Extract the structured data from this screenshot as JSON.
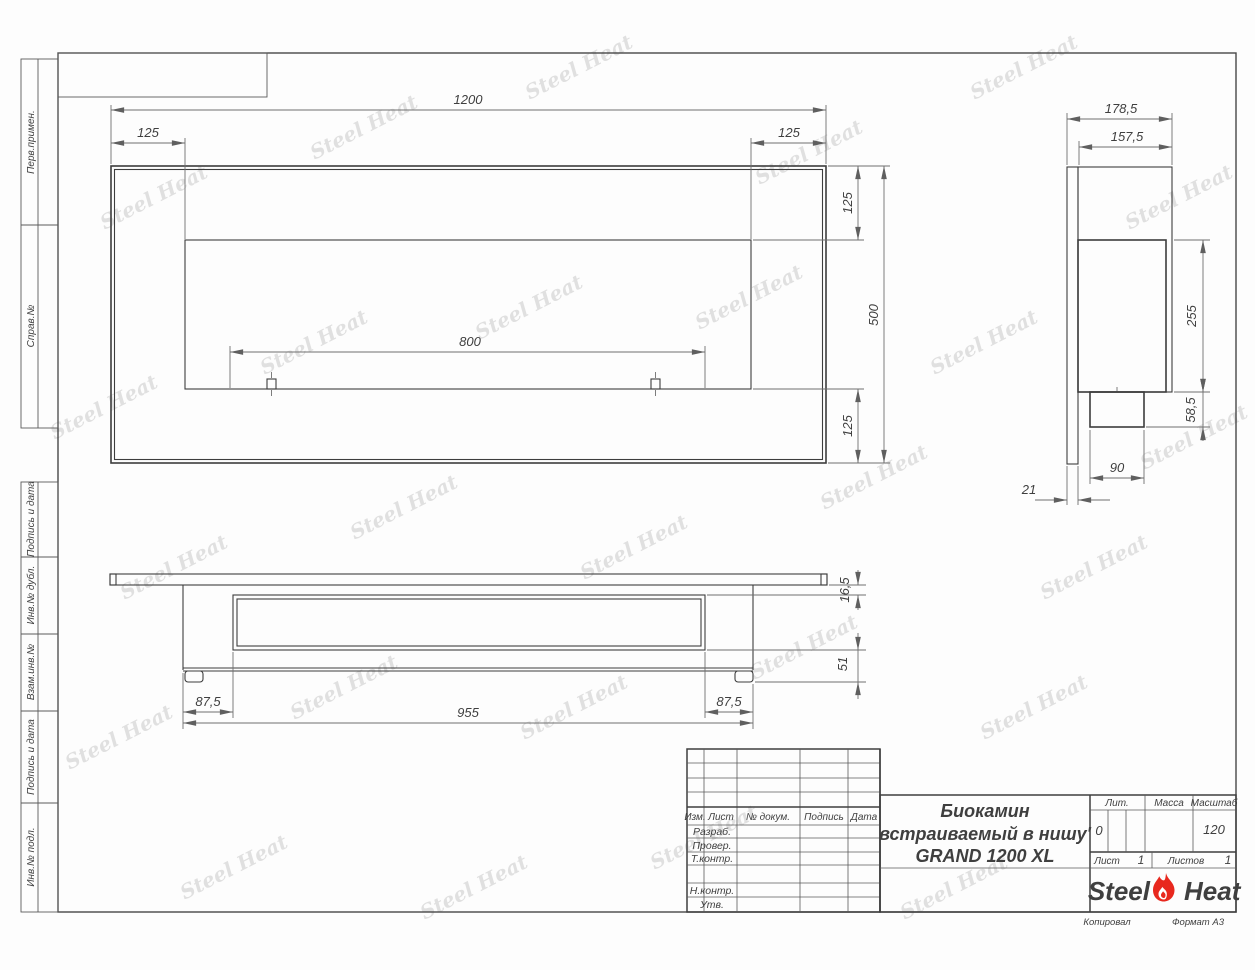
{
  "watermark": {
    "text": "Steel Heat"
  },
  "left_strip": {
    "items": [
      "Перв.примен.",
      "Справ.№",
      "Подпись и дата",
      "Инв.№ дубл.",
      "Взам.инв.№",
      "Подпись и дата",
      "Инв.№ подл."
    ]
  },
  "title_block": {
    "header_cols": {
      "izm": "Изм.",
      "list": "Лист",
      "doc": "№ докум.",
      "sign": "Подпись",
      "date": "Дата"
    },
    "rows": {
      "razrab": "Разраб.",
      "prover": "Провер.",
      "tkontr": "Т.контр.",
      "nkontr": "Н.контр.",
      "utv": "Утв."
    },
    "title_line1": "Биокамин",
    "title_line2": "встраиваемый в нишу'",
    "title_line3": "GRAND 1200 XL",
    "lit_label": "Лит.",
    "lit_value": "0",
    "mass_label": "Масса",
    "scale_label": "Масштаб",
    "scale_value": "120",
    "sheet_label": "Лист",
    "sheet_value": "1",
    "sheets_label": "Листов",
    "sheets_value": "1",
    "logo": {
      "steel": "Steel",
      "heat": "Heat",
      "flame_color": "#e8281e"
    },
    "footer_left": "Копировал",
    "footer_right": "Формат А3"
  },
  "dimensions": {
    "front": {
      "width": "1200",
      "left": "125",
      "right": "125",
      "top": "125",
      "height": "500",
      "bottom": "125",
      "opening": "800"
    },
    "side": {
      "depth_total": "178,5",
      "depth_body": "157,5",
      "inner_height": "255",
      "lower_height": "58,5",
      "lower_width": "90",
      "flange": "21"
    },
    "bottom": {
      "flange": "16,5",
      "depth": "51",
      "left": "87,5",
      "right": "87,5",
      "width": "955"
    }
  }
}
